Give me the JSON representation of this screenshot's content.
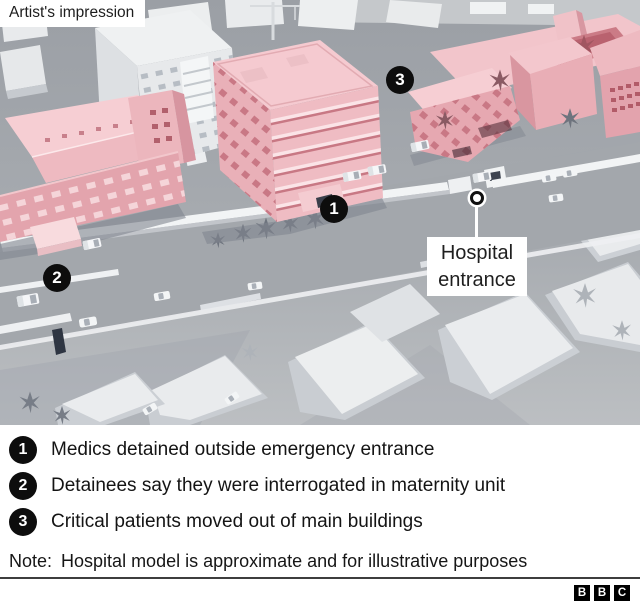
{
  "type_label": "Artist's impression",
  "map": {
    "markers": [
      {
        "number": "1"
      },
      {
        "number": "2"
      },
      {
        "number": "3"
      }
    ],
    "entrance": {
      "line1": "Hospital",
      "line2": "entrance"
    }
  },
  "legend": {
    "items": [
      {
        "number": "1",
        "text": "Medics detained outside emergency entrance"
      },
      {
        "number": "2",
        "text": "Detainees say they were interrogated in maternity unit"
      },
      {
        "number": "3",
        "text": "Critical patients moved out of main buildings"
      }
    ],
    "note_label": "Note:",
    "note_text": "Hospital model is approximate and for illustrative purposes"
  },
  "logo": {
    "letters": [
      "B",
      "B",
      "C"
    ]
  },
  "colors": {
    "highlight_pink": "#f2c4ca",
    "marker_black": "#0d0d0d",
    "map_grey": "#a5a9ae",
    "divider_grey": "#3e3e3e"
  }
}
